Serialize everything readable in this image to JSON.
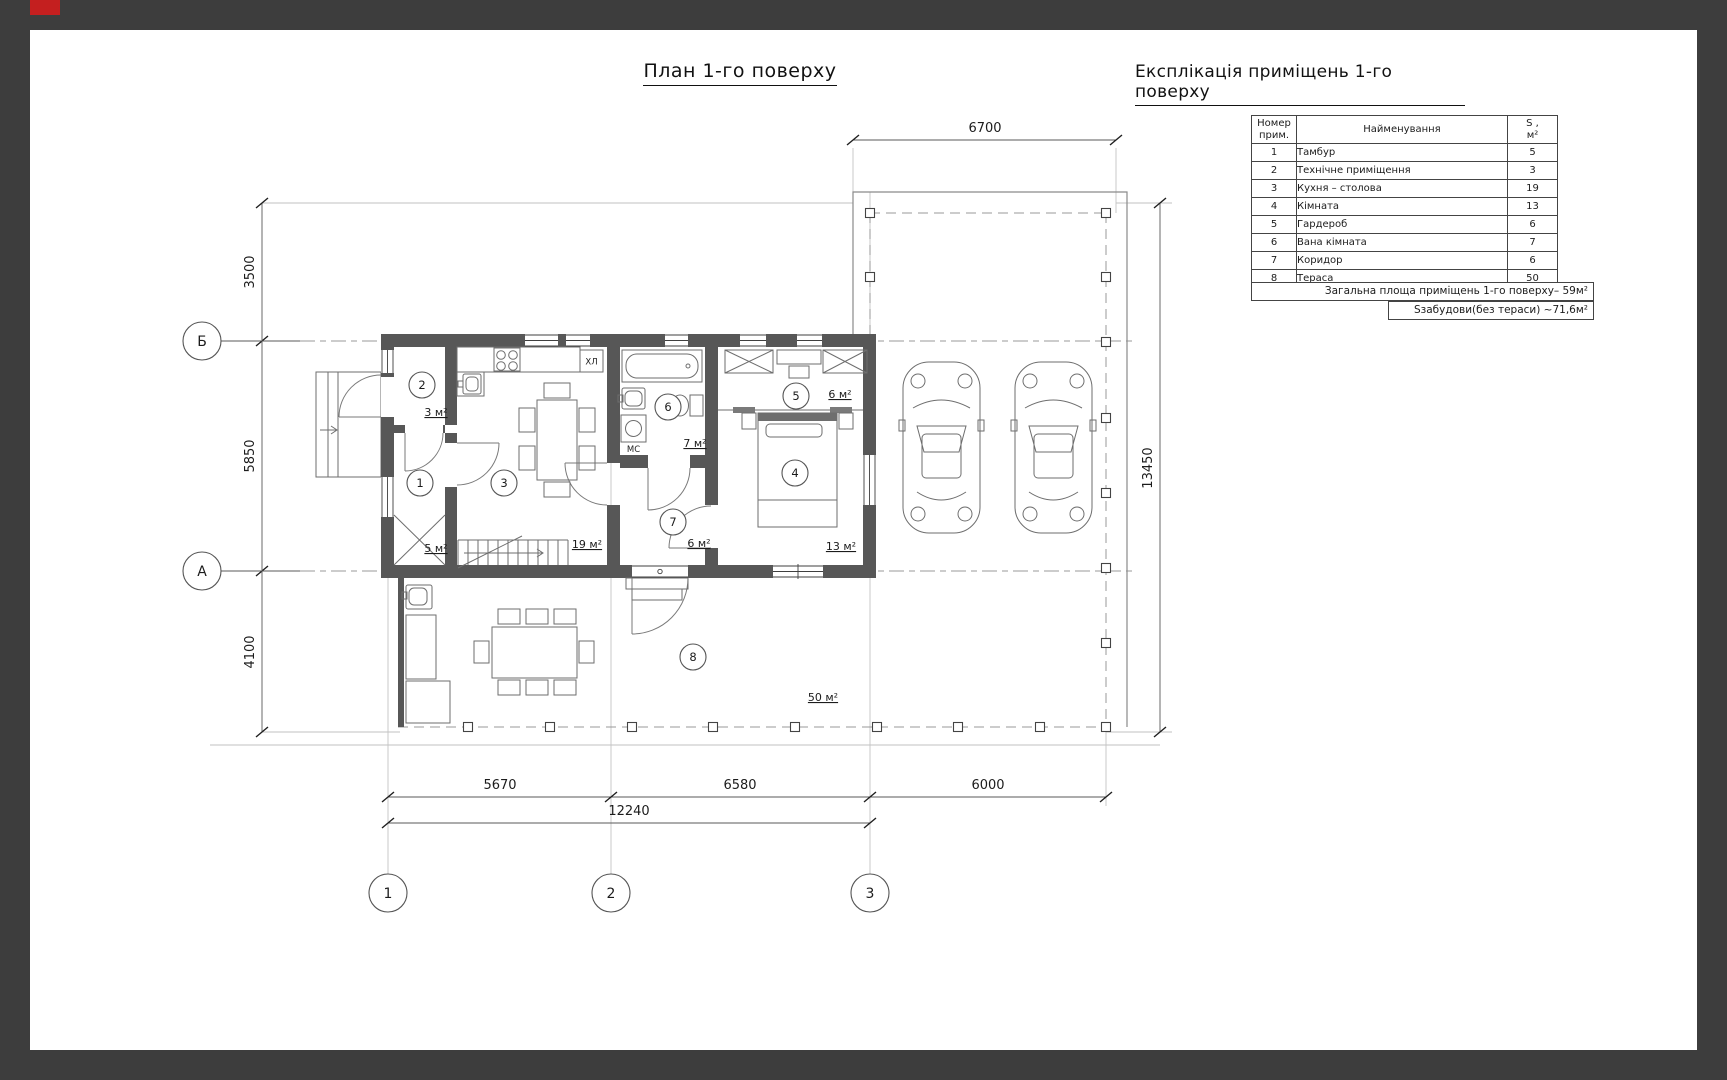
{
  "page": {
    "title": "План 1-го поверху",
    "accent_color": "#c41f1f"
  },
  "plan": {
    "appliance_labels": {
      "fridge": "ХЛ",
      "washer": "МС"
    },
    "grid_axes": {
      "horizontal": [
        "Б",
        "А"
      ],
      "vertical": [
        "1",
        "2",
        "3"
      ]
    },
    "dimensions": {
      "top": "6700",
      "right": "13450",
      "left": [
        "3500",
        "5850",
        "4100"
      ],
      "bottom_segments": [
        "5670",
        "6580",
        "6000"
      ],
      "bottom_total": "12240"
    },
    "rooms": [
      {
        "num": "1",
        "name": "Тамбур",
        "area": "5",
        "area_label": "5 м²"
      },
      {
        "num": "2",
        "name": "Технічне приміщення",
        "area": "3",
        "area_label": "3 м²"
      },
      {
        "num": "3",
        "name": "Кухня – столова",
        "area": "19",
        "area_label": "19 м²"
      },
      {
        "num": "4",
        "name": "Кімната",
        "area": "13",
        "area_label": "13 м²"
      },
      {
        "num": "5",
        "name": "Гардероб",
        "area": "6",
        "area_label": "6 м²"
      },
      {
        "num": "6",
        "name": "Вана кімната",
        "area": "7",
        "area_label": "7 м²"
      },
      {
        "num": "7",
        "name": "Коридор",
        "area": "6",
        "area_label": "6 м²"
      },
      {
        "num": "8",
        "name": "Тераса",
        "area": "50",
        "area_label": "50 м²"
      }
    ]
  },
  "legend": {
    "title": "Експлікація приміщень 1-го поверху",
    "header": {
      "col1_line1": "Номер",
      "col1_line2": "прим.",
      "col2": "Найменування",
      "col3_line1": "S ,",
      "col3_line2": "м²"
    },
    "footer_total": "Загальна площа приміщень 1-го поверху– 59м²",
    "footer_built": "Sзабудови(без тераси)  ~71,6м²"
  }
}
